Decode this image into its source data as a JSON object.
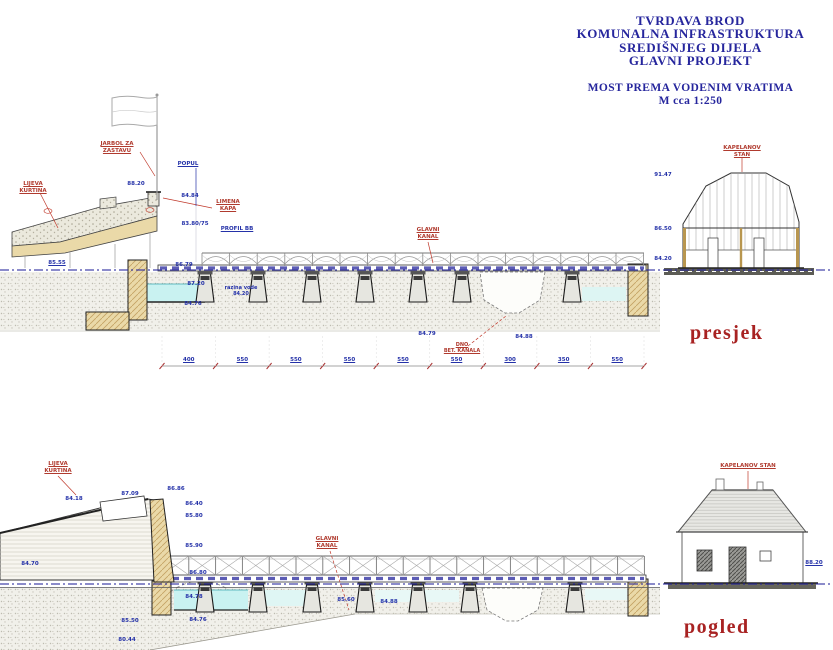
{
  "title_block": {
    "line1": "TVRDAVA BROD",
    "line2": "KOMUNALNA INFRASTRUKTURA",
    "line3": "SREDIŠNJEG DIJELA",
    "line4": "GLAVNI PROJEKT",
    "subtitle1": "MOST PREMA VODENIM VRATIMA",
    "subtitle2": "M  cca 1:250"
  },
  "presjek": {
    "label": "presjek",
    "annotations": {
      "jarbol": "JARBOL ZA\nZASTAVU",
      "popul": "POPUL",
      "kurtina": "LIJEVA\nKURTINA",
      "limena_kapa": "LIMENA\nKAPA",
      "profil": "PROFIL BB",
      "razina_vode": "razina vode\n84.20",
      "glavni_kanal": "GLAVNI\nKANAL",
      "dno_kanala": "DNO\nBET. KANALA",
      "kapelanov_stan": "KAPELANOV\nSTAN"
    },
    "elevations": {
      "e1": "88.20",
      "e2": "84.84",
      "e3": "83.80/75",
      "e4": "85.55",
      "e5": "86.79",
      "e6": "87.20",
      "e7": "84.76",
      "e8": "84.79",
      "e9": "84.88",
      "e10": "91.47",
      "e11": "86.50",
      "e12": "84.20"
    },
    "dimensions": [
      "400",
      "550",
      "550",
      "550",
      "550",
      "550",
      "300",
      "350",
      "550"
    ]
  },
  "pogled": {
    "label": "pogled",
    "annotations": {
      "kurtina": "LIJEVA\nKURTINA",
      "glavni_kanal": "GLAVNI\nKANAL",
      "kapelanov_stan": "KAPELANOV STAN"
    },
    "elevations": {
      "e1": "84.18",
      "e2": "87.09",
      "e3": "86.86",
      "e4": "86.40",
      "e5": "85.80",
      "e6": "85.90",
      "e7": "86.80",
      "e8": "84.78",
      "e9": "84.76",
      "e10": "85.60",
      "e11": "84.88",
      "e12": "88.20",
      "e13": "84.70",
      "e14": "85.50",
      "e15": "80.44"
    }
  },
  "colors": {
    "title_navy": "#26269d",
    "red_label": "#b03a2e",
    "blue_label": "#2431a8",
    "heading_red": "#a82222",
    "water": "#c9f2f1",
    "masonry_tan": "#ead9a8"
  }
}
